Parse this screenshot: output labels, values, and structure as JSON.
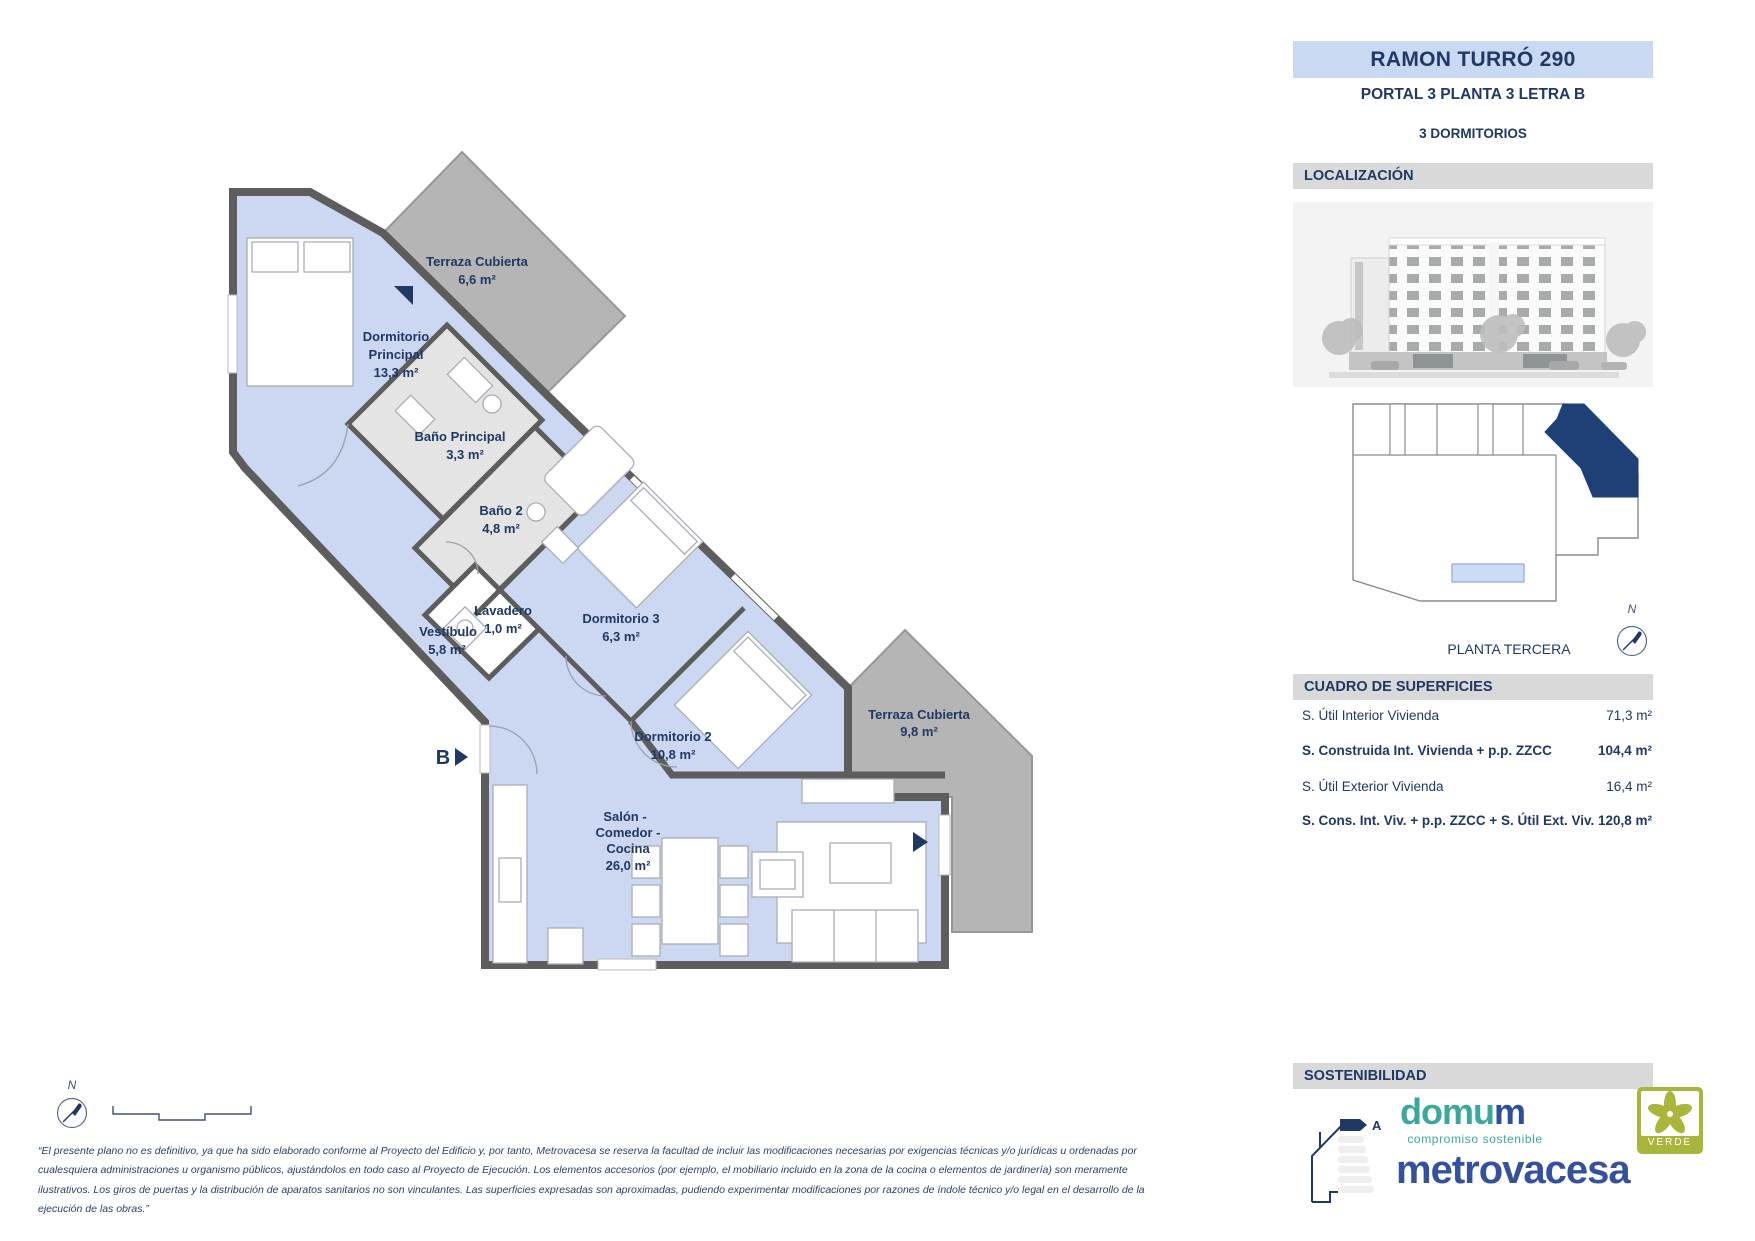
{
  "header": {
    "title": "RAMON TURRÓ 290",
    "portal": "PORTAL 3 PLANTA 3 LETRA B",
    "bedrooms": "3 DORMITORIOS"
  },
  "sections": {
    "localizacion": "LOCALIZACIÓN",
    "planta": "PLANTA TERCERA",
    "cuadro": "CUADRO DE SUPERFICIES",
    "sostenibilidad": "SOSTENIBILIDAD"
  },
  "surfaces": {
    "rows": [
      {
        "label": "S. Útil Interior Vivienda",
        "value": "71,3 m²"
      },
      {
        "label": "S. Construida Int. Vivienda + p.p. ZZCC",
        "value": "104,4 m²"
      },
      {
        "label": "S. Útil Exterior Vivienda",
        "value": "16,4 m²"
      },
      {
        "label": "S. Cons. Int. Viv. + p.p. ZZCC + S. Útil Ext. Viv.",
        "value": "120,8 m²"
      }
    ]
  },
  "plan": {
    "unit_label": "B",
    "north_label": "N",
    "rooms": [
      {
        "id": "terraza-cubierta-1",
        "lines": [
          "Terraza Cubierta"
        ],
        "area": "6,6 m²"
      },
      {
        "id": "dormitorio-principal",
        "lines": [
          "Dormitorio",
          "Principal"
        ],
        "area": "13,3 m²"
      },
      {
        "id": "bano-principal",
        "lines": [
          "Baño Principal"
        ],
        "area": "3,3 m²"
      },
      {
        "id": "bano-2",
        "lines": [
          "Baño 2"
        ],
        "area": "4,8 m²"
      },
      {
        "id": "lavadero",
        "lines": [
          "Lavadero"
        ],
        "area": "1,0 m²"
      },
      {
        "id": "vestibulo",
        "lines": [
          "Vestíbulo"
        ],
        "area": "5,8 m²"
      },
      {
        "id": "dormitorio-3",
        "lines": [
          "Dormitorio 3"
        ],
        "area": "6,3 m²"
      },
      {
        "id": "dormitorio-2",
        "lines": [
          "Dormitorio 2"
        ],
        "area": "10,8 m²"
      },
      {
        "id": "salon-comedor-cocina",
        "lines": [
          "Salón -",
          "Comedor -",
          "Cocina"
        ],
        "area": "26,0 m²"
      },
      {
        "id": "terraza-cubierta-2",
        "lines": [
          "Terraza Cubierta"
        ],
        "area": "9,8 m²"
      }
    ],
    "colors": {
      "room_blue": "#ccd8f1",
      "terrace_gray": "#b5b5b5",
      "bath_gray": "#e4e4e4",
      "wall": "#5d5d5d",
      "navy": "#1f3864"
    }
  },
  "logos": {
    "energy_rating": "A",
    "domum_part1": "domu",
    "domum_part2": "m",
    "domum_tagline": "compromiso sostenible",
    "metrovacesa": "metrovacesa",
    "verde": "VERDE"
  },
  "disclaimer": "“El presente plano no es definitivo, ya que ha sido elaborado conforme al Proyecto del Edificio y, por tanto, Metrovacesa se reserva la facultad de incluir las modificaciones necesarias por exigencias técnicas y/o jurídicas u ordenadas por cualesquiera administraciones u organismo públicos, ajustándolos en todo caso al Proyecto de Ejecución. Los elementos accesorios (por ejemplo, el mobiliario incluido en la zona de la cocina o elementos de jardinería) son meramente ilustrativos. Los giros de puertas y la distribución de aparatos sanitarios no son vinculantes. Las superficies expresadas son aproximadas, pudiendo experimentar modificaciones por razones de índole técnico y/o legal en el desarrollo de la ejecución de las obras.”"
}
